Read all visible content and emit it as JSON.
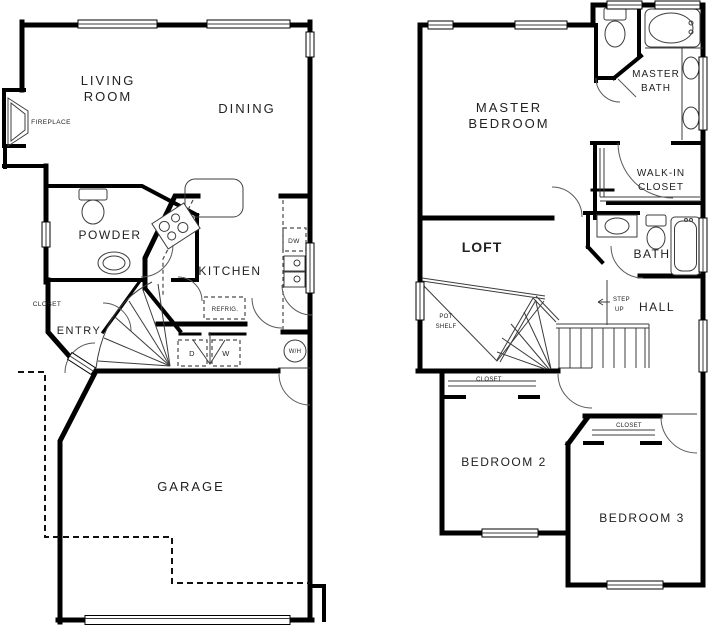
{
  "colors": {
    "wall": "#000000",
    "thin_line": "#3c3c3c",
    "loft_text": "#fe0000"
  },
  "floor1": {
    "living_room": [
      "LIVING",
      "ROOM"
    ],
    "dining": "DINING",
    "kitchen": "KITCHEN",
    "powder": "POWDER",
    "entry": "ENTRY",
    "garage": "GARAGE",
    "fireplace": "FIREPLACE",
    "closet": "CLOSET",
    "refrigerator": "REFRIG.",
    "dryer": "D",
    "washer": "W",
    "dishwasher": "DW",
    "water_heater": "W/H"
  },
  "floor2": {
    "master_bedroom": [
      "MASTER",
      "BEDROOM"
    ],
    "master_bath": [
      "MASTER",
      "BATH"
    ],
    "walk_in_closet": [
      "WALK-IN",
      "CLOSET"
    ],
    "loft": "LOFT",
    "bath": "BATH",
    "hall": "HALL",
    "step_up": [
      "STEP",
      "UP"
    ],
    "pot_shelf": [
      "POT",
      "SHELF"
    ],
    "closet_bedroom2": "CLOSET",
    "closet_bedroom3": "CLOSET",
    "bedroom2": "BEDROOM 2",
    "bedroom3": "BEDROOM 3"
  }
}
